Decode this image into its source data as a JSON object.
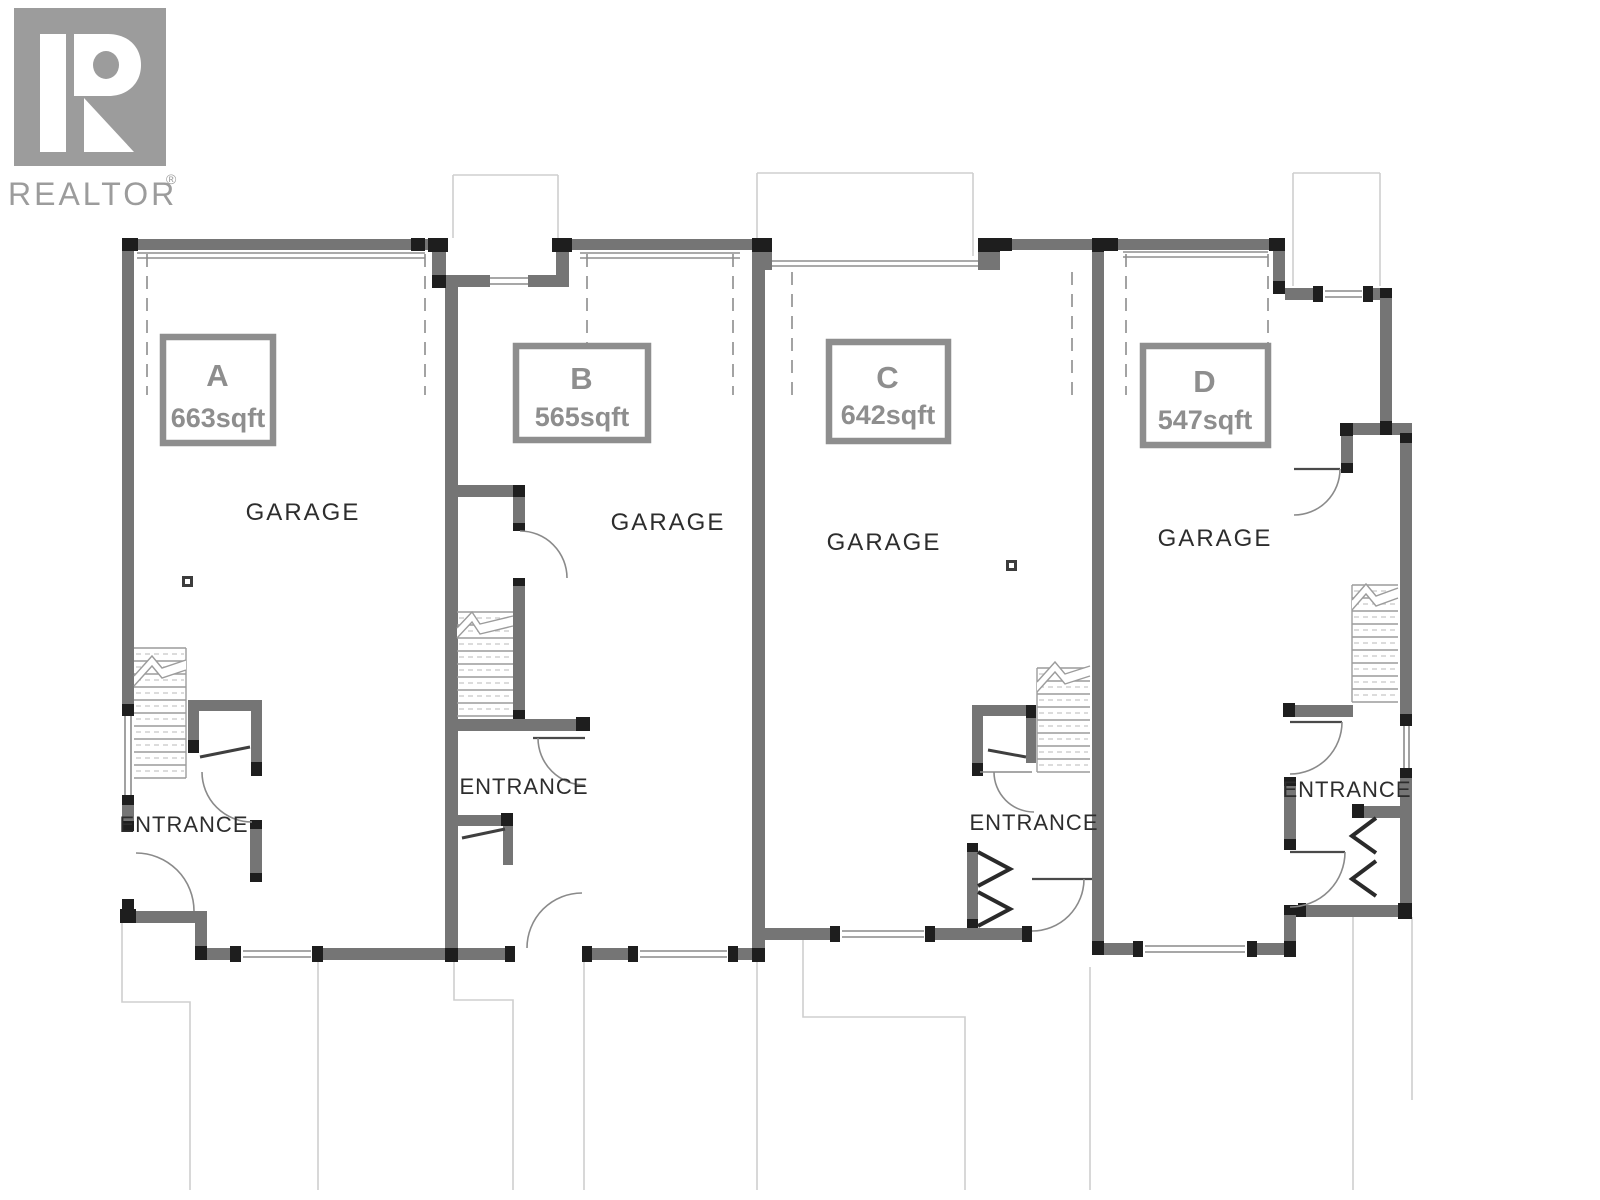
{
  "branding": {
    "logo_letter": "R",
    "logo_text": "REALTOR",
    "registered_mark": "®",
    "logo_color": "#9c9c9c"
  },
  "plan": {
    "wall_color": "#757575",
    "accent_color": "#1e1e1e",
    "label_color": "#8e8e8e",
    "text_color": "#2d2d2d"
  },
  "units": [
    {
      "id": "A",
      "area": "663sqft",
      "room_label": "GARAGE",
      "entrance_label": "ENTRANCE"
    },
    {
      "id": "B",
      "area": "565sqft",
      "room_label": "GARAGE",
      "entrance_label": "ENTRANCE"
    },
    {
      "id": "C",
      "area": "642sqft",
      "room_label": "GARAGE",
      "entrance_label": "ENTRANCE"
    },
    {
      "id": "D",
      "area": "547sqft",
      "room_label": "GARAGE",
      "entrance_label": "ENTRANCE"
    }
  ]
}
